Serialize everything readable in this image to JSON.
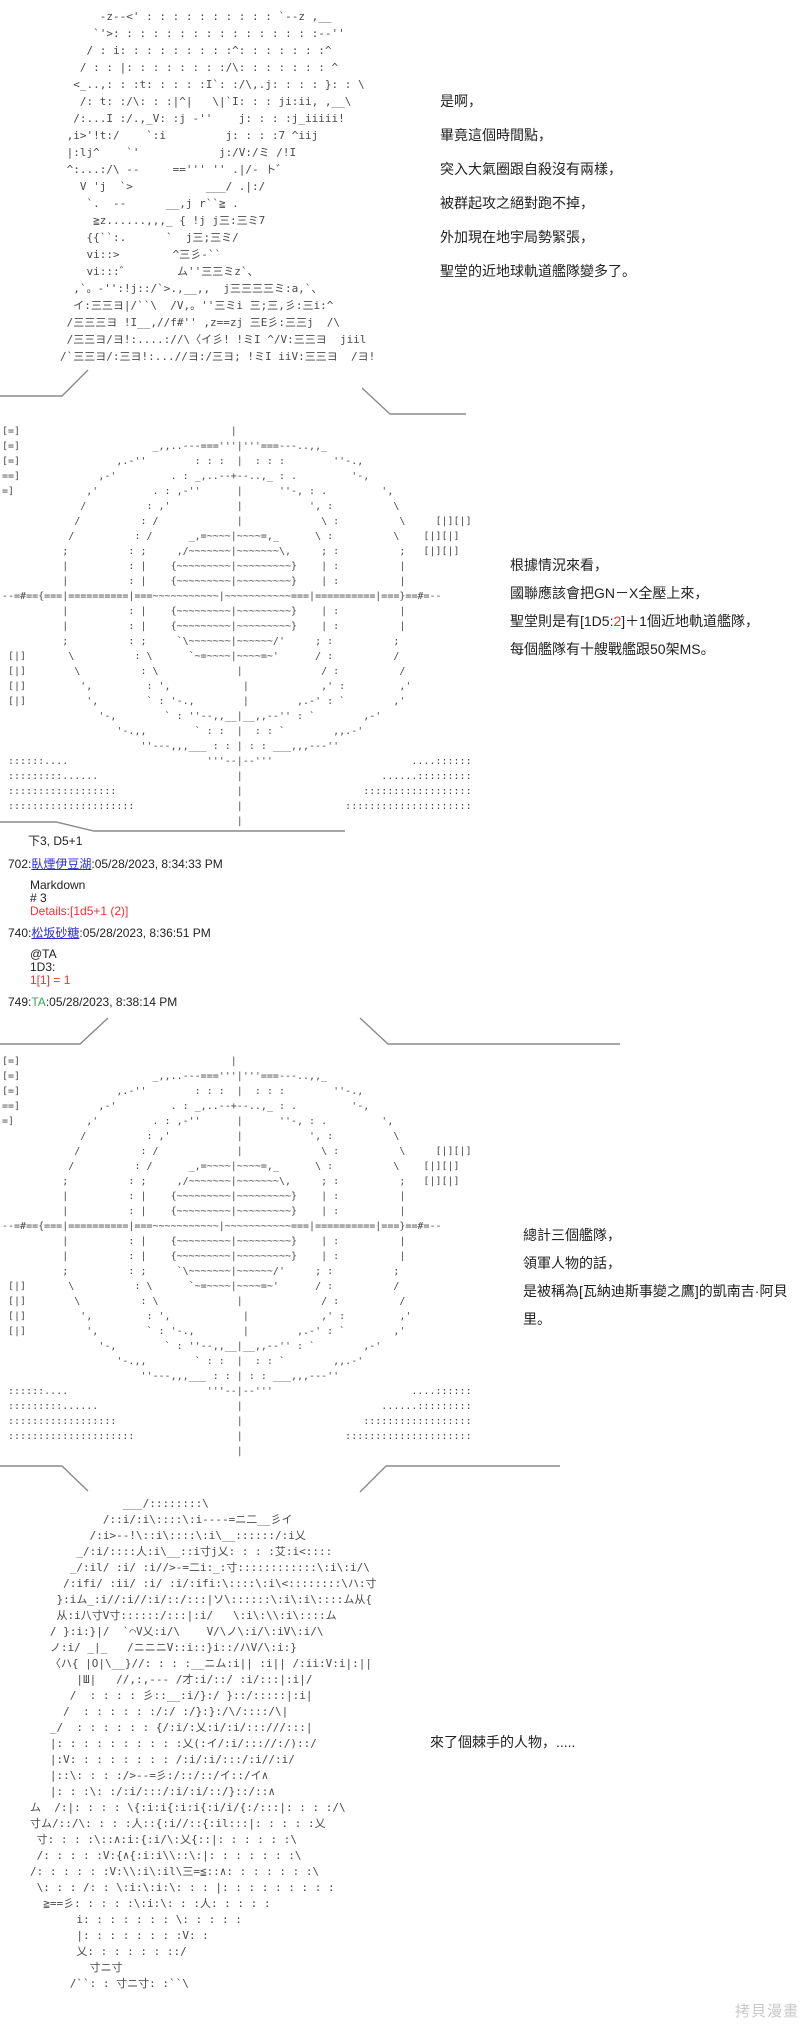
{
  "colors": {
    "background": "#ffffff",
    "aa_ink": "#4a4a4a",
    "text_ink": "#222222",
    "link_blue": "#2b2bd5",
    "dice_red": "#e8352e",
    "ta_green": "#3aa655",
    "watermark_gray": "#c9c9c9"
  },
  "dialogues": {
    "d1": {
      "lines": [
        "是啊，",
        "畢竟這個時間點，",
        "突入大氣圈跟自殺沒有兩樣，",
        "被群起攻之絕對跑不掉，",
        "外加現在地宇局勢緊張，",
        "聖堂的近地球軌道艦隊變多了。"
      ]
    },
    "d2": {
      "line1": "根據情況來看，",
      "line2": "國聯應該會把GN－X全壓上來，",
      "line3_pre": "聖堂則是有[1D5:",
      "line3_roll": "2",
      "line3_post": "]＋1個近地軌道艦隊，",
      "line4": "每個艦隊有十艘戰艦跟50架MS。"
    },
    "d3": {
      "lines": [
        "總計三個艦隊，",
        "領軍人物的話，",
        "是被稱為[瓦納迪斯事變之鷹]的凱南吉·阿貝里。"
      ]
    },
    "d4": {
      "line": "來了個棘手的人物，....."
    }
  },
  "posts": {
    "note": "下3, D5+1",
    "p1": {
      "num": "702:",
      "author": "臥煙伊豆湖",
      "time": ":05/28/2023, 8:34:33 PM",
      "quote": [
        "Markdown",
        "# 3"
      ],
      "result": "Details:[1d5+1 (2)]"
    },
    "p2": {
      "num": "740:",
      "author": "松坂砂糖",
      "time": ":05/28/2023, 8:36:51 PM",
      "quote": [
        "@TA",
        "1D3:"
      ],
      "result": "1[1] = 1"
    },
    "p3": {
      "num": "749:",
      "author": "TA",
      "time": ":05/28/2023, 8:38:14 PM"
    }
  },
  "watermark": "拷貝漫畫",
  "ascii": {
    "top_character": [
      "      -z--<' : : : : : : : : : : `--z ,__",
      "     `'>: : : : : : : : : : : : : : : :--''",
      "    / : i: : : : : : : : :^: : : : : : :^",
      "   / : : |: : : : : : : :/\\: : : : : : : ^",
      "  <_..,: : :t: : : : :I`: :/\\,.j: : : : }: : \\",
      "   /: t: :/\\: : :|^|   \\|`I: : : ji:ii, ,__\\",
      "  /:...I :/.,_V: :j -''    j: : : :j_iiiii!",
      " ,i>'!t:/    `:i         j: : : :7 ^iij",
      " |:lj^    `'            j:/V:/ミ /!I",
      " ^:...:/\\ --     ==''' '' .|/- ト゛",
      "   V 'j  `>           ___/ .|:/",
      "    `.  --      __,j r``≧ .",
      "     ≧z......,,,_ { !j j三:三ミ7",
      "    {{``:.      `  j三;三ミ/",
      "    vi::>        ^三彡-``",
      "    vi:::゛       ム''三三ミz`、",
      "  ,`。-'':!j::/`>.,__,,  j三三三三ミ:a,`、",
      "  イ:三三ヨ|/``\\  /V,。''三ミi 三;三,彡:三i:^",
      " /三三三ヨ !I__,//f#'' ,z==zj 三E彡:三三j  /\\",
      " /三三ヨ/ヨ!:....://\\〈イ彡! !ミI ^/V:三三ヨ  jiil",
      "/`三三ヨ/:三ヨ!:...//ヨ:/三ヨ; !ミI iiV:三三ヨ  /ヨ!"
    ],
    "orbital_map": [
      "[=]                                   |",
      "[=]                      _,,..---==='''|'''===---..,,_",
      "[=]                ,.-''        : : :  |  : : :        ''-.,",
      "==]             ,-'         . : _,..--+--..,_ : .         '-,",
      "=]            ,'         . : ,-''      |      ''-, : .         ',",
      "             /          : ,'           |           ', :          \\",
      "            /          : /             |             \\ :          \\     [|][|]",
      "           /          : /      _,=~~~~|~~~~=,_      \\ :          \\    [|][|]",
      "          ;          : ;     ,/~~~~~~~|~~~~~~~\\,     ; :          ;   [|][|]",
      "          |          : |    {~~~~~~~~~|~~~~~~~~~}    | :          |",
      "          |          : |    {~~~~~~~~~|~~~~~~~~~}    | :          |",
      "--=#=={===|==========|===~~~~~~~~~~~|~~~~~~~~~~~===|==========|===}==#=--",
      "          |          : |    {~~~~~~~~~|~~~~~~~~~}    | :          |",
      "          |          : |    {~~~~~~~~~|~~~~~~~~~}    | :          |",
      "          ;          : ;     `\\~~~~~~~|~~~~~~/'     ; :          ;",
      " [|]       \\          : \\      `~=~~~~|~~~~=~'      / :          /",
      " [|]        \\          : \\             |             / :          /",
      " [|]         ',         : ',            |            ,' :         ,'",
      " [|]          ',        ` : '-.,        |        ,.-' : `        ,'",
      "                '-,        ` : ''--,,__|__,,--'' : `        ,-'",
      "                   '-.,,        ` : :  |  : : `        ,,.-'",
      "                       ''---,,,___ : : | : : ___,,,---''",
      " ::::::....                       '''--|--'''                       ....::::::",
      " :::::::::......                       |                       ......:::::::::",
      " ::::::::::::::::::                    |                    ::::::::::::::::::",
      " :::::::::::::::::::::                 |                 :::::::::::::::::::::",
      "                                       |"
    ],
    "bottom_character": [
      "              ___/::::::::\\",
      "           /::i/:i\\::::\\:i----=ニ二__彡イ",
      "         /:i>--!\\::i\\::::\\:i\\__::::::/:i乂",
      "       _/:i/::::人:i\\__::i寸j乂: : : :艾:i<::::",
      "      _/:il/ :i/ :i//>-=二i:_:寸::::::::::::\\:i\\:i/\\",
      "     /:ifi/ :ii/ :i/ :i/:ifi:\\::::\\:i\\<::::::::\\ハ:寸",
      "    }:iム_:i//:i//:i/::/:::|ソ\\::::::\\:i\\:i\\::::ム从{",
      "    从:i八寸V寸::::::/:::|:i/   \\:i\\:\\\\:i\\::::ム",
      "   / }:i:}|/  `⌒V乂:i/\\    V/\\ノ\\:i/\\:iV\\:i/\\",
      "   ノ:i/ _|_   /ニニニV::i::}i::/ハV/\\:i:}",
      "   〈ハ{ |O|\\__}//: : : :__ニム:i|| :i|| /:ii:V:i|:||",
      "       |Ш|   //,:,--- /才:i/::/ :i/:::|:i|/",
      "      /  : : : : 彡::__:i/}:/ }::/:::::|:i|",
      "     /  : : : : : :/:/ :/}:}:/\\/::::/\\|",
      "   _/  : : : : : : {/:i/:乂:i/:i/:::///:::|",
      "   |: : : : : : : : : :乂(:イ/:i/::://:/)::/",
      "   |:V: : : : : : : : /:i/:i/:::/:i//:i/",
      "   |::\\: : : :/>--=彡:/::/::/イ::/イ∧",
      "   |: : :\\: :/:i/:::/:i/:i/::/}::/::∧",
      "ム  /:|: : : : \\{:i:i{:i:i{:i/i/{:/:::|: : : :/\\",
      "寸ム/::/\\: : : :人::{:i//::{:il:::|: : : : :乂",
      " 寸: : : :\\::∧:i:{:i/\\:乂{::|: : : : : :\\",
      " /: : : : :V:{∧{:i:i\\\\::\\:|: : : : : : :\\",
      "/: : : : : :V:\\\\:i\\:il\\三=≦::∧: : : : : : :\\",
      " \\: : : /: : \\:i:\\:i:\\: : : |: : : : : : : : :",
      "  ≧==彡: : : : :\\:i:\\: : :人: : : : :",
      "       i: : : : : : : \\: : : : :",
      "       |: : : : : : : :V: :",
      "       乂: : : : : : ::/",
      "         寸ニ寸",
      "      /``: : 寸ニ寸: :``\\"
    ]
  }
}
